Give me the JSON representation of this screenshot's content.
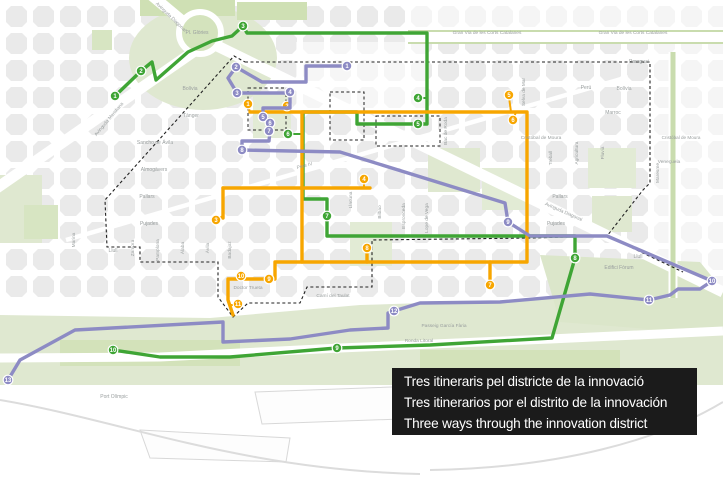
{
  "title_box": {
    "lines": [
      "Tres itineraris pel districte de la innovació",
      "Tres itinerarios por el distrito de la innovación",
      "Three ways through the innovation district"
    ],
    "bg_color": "#1b1b1b",
    "text_color": "#ffffff"
  },
  "map": {
    "colors": {
      "green_route": "#3fa535",
      "orange_route": "#f7a600",
      "purple_route": "#8d8bc4",
      "block": "#eaeaea",
      "park": "#dfe8d0",
      "park_bright": "#cfe0b4",
      "label": "#999e9e",
      "boundary": "#222222"
    },
    "place_labels": [
      {
        "t": "Gran Via de les Corts Catalanes",
        "x": 487,
        "y": 34,
        "s": 4.8
      },
      {
        "t": "Gran Via de les Corts Catalanes",
        "x": 633,
        "y": 34,
        "s": 4.8
      },
      {
        "t": "Pl. Glòries",
        "x": 197,
        "y": 34,
        "s": 5
      },
      {
        "t": "Avinguda Diagonal",
        "x": 170,
        "y": 18,
        "r": 44,
        "s": 4.8
      },
      {
        "t": "Avinguda Diagonal",
        "x": 563,
        "y": 213,
        "r": 24,
        "s": 4.8
      },
      {
        "t": "Avinguda Meridiana",
        "x": 110,
        "y": 120,
        "r": -50,
        "s": 4.8
      },
      {
        "t": "Pere IV",
        "x": 305,
        "y": 167,
        "r": -15,
        "s": 4.8
      },
      {
        "t": "Bolívia",
        "x": 190,
        "y": 90,
        "s": 5
      },
      {
        "t": "Bolívia",
        "x": 624,
        "y": 90,
        "s": 5
      },
      {
        "t": "Tànger",
        "x": 191,
        "y": 117,
        "s": 5
      },
      {
        "t": "Sancho de Ávila",
        "x": 155,
        "y": 144,
        "s": 5
      },
      {
        "t": "Almogàvers",
        "x": 154,
        "y": 171,
        "s": 5
      },
      {
        "t": "Pallars",
        "x": 147,
        "y": 198,
        "s": 5
      },
      {
        "t": "Pallars",
        "x": 560,
        "y": 198,
        "s": 5
      },
      {
        "t": "Pujades",
        "x": 149,
        "y": 225,
        "s": 5
      },
      {
        "t": "Pujades",
        "x": 556,
        "y": 225,
        "s": 5
      },
      {
        "t": "Llull",
        "x": 113,
        "y": 252,
        "s": 5
      },
      {
        "t": "Llull",
        "x": 638,
        "y": 258,
        "s": 5
      },
      {
        "t": "Doctor Trueta",
        "x": 248,
        "y": 289,
        "s": 4.8
      },
      {
        "t": "Camí del Taulat",
        "x": 333,
        "y": 297,
        "s": 4.8
      },
      {
        "t": "Passeig García Fària",
        "x": 444,
        "y": 327,
        "s": 4.8
      },
      {
        "t": "Ronda Litoral",
        "x": 419,
        "y": 342,
        "s": 4.8
      },
      {
        "t": "Cristóbal de Moura",
        "x": 541,
        "y": 139,
        "s": 4.8
      },
      {
        "t": "Cristóbal de Moura",
        "x": 681,
        "y": 139,
        "s": 4.6
      },
      {
        "t": "Marroc",
        "x": 613,
        "y": 114,
        "s": 5
      },
      {
        "t": "Perú",
        "x": 586,
        "y": 89,
        "s": 5
      },
      {
        "t": "Paraguai",
        "x": 639,
        "y": 63,
        "s": 5
      },
      {
        "t": "Veneçuela",
        "x": 669,
        "y": 163,
        "s": 4.8
      },
      {
        "t": "Edifici Fòrum",
        "x": 619,
        "y": 269,
        "s": 5
      },
      {
        "t": "Port Olímpic",
        "x": 114,
        "y": 398,
        "s": 5
      },
      {
        "t": "Marina",
        "x": 75,
        "y": 240,
        "r": -90,
        "s": 4.8
      },
      {
        "t": "Zamora",
        "x": 134,
        "y": 248,
        "r": -90,
        "s": 4.8
      },
      {
        "t": "Pamplona",
        "x": 159,
        "y": 250,
        "r": -90,
        "s": 4.8
      },
      {
        "t": "Àlaba",
        "x": 184,
        "y": 248,
        "r": -90,
        "s": 4.8
      },
      {
        "t": "Àvila",
        "x": 209,
        "y": 248,
        "r": -90,
        "s": 4.8
      },
      {
        "t": "Badajoz",
        "x": 231,
        "y": 250,
        "r": -90,
        "s": 4.8
      },
      {
        "t": "Llacuna",
        "x": 352,
        "y": 200,
        "r": -90,
        "s": 4.8
      },
      {
        "t": "Bilbao",
        "x": 381,
        "y": 212,
        "r": -90,
        "s": 4.8
      },
      {
        "t": "Espronceda",
        "x": 405,
        "y": 216,
        "r": -90,
        "s": 4.8
      },
      {
        "t": "Lope de Vega",
        "x": 428,
        "y": 218,
        "r": -90,
        "s": 4.8
      },
      {
        "t": "Bac de Roda",
        "x": 447,
        "y": 131,
        "r": -90,
        "s": 4.8
      },
      {
        "t": "Selva de Mar",
        "x": 525,
        "y": 92,
        "r": -90,
        "s": 4.8
      },
      {
        "t": "Treball",
        "x": 552,
        "y": 158,
        "r": -90,
        "s": 4.8
      },
      {
        "t": "Agricultura",
        "x": 578,
        "y": 153,
        "r": -90,
        "s": 4.8
      },
      {
        "t": "Fluvià",
        "x": 604,
        "y": 153,
        "r": -90,
        "s": 4.8
      },
      {
        "t": "Maresme",
        "x": 659,
        "y": 173,
        "r": -90,
        "s": 4.8
      }
    ],
    "boundary": {
      "loop": [
        [
          245,
          62
        ],
        [
          650,
          62
        ],
        [
          650,
          183
        ],
        [
          643,
          190
        ],
        [
          607,
          236
        ],
        [
          530,
          238
        ],
        [
          372,
          240
        ],
        [
          372,
          287
        ],
        [
          307,
          287
        ],
        [
          300,
          303
        ],
        [
          248,
          303
        ],
        [
          233,
          317
        ],
        [
          218,
          297
        ],
        [
          218,
          262
        ],
        [
          140,
          262
        ],
        [
          140,
          247
        ],
        [
          107,
          247
        ],
        [
          105,
          200
        ],
        [
          234,
          56
        ],
        [
          245,
          62
        ]
      ],
      "spur": [
        [
          607,
          236
        ],
        [
          683,
          272
        ]
      ],
      "inner_boxes": [
        [
          248,
          88,
          38,
          42
        ],
        [
          330,
          92,
          34,
          48
        ],
        [
          376,
          116,
          64,
          30
        ]
      ]
    },
    "routes": [
      {
        "id": "green-route",
        "color": "#3fa535",
        "paths": [
          [
            [
              115,
              96
            ],
            [
              141,
              71
            ],
            [
              152,
              62
            ],
            [
              156,
              80
            ],
            [
              188,
              52
            ],
            [
              212,
              41
            ],
            [
              232,
              36
            ],
            [
              243,
              26
            ],
            [
              247,
              33
            ],
            [
              427,
              33
            ],
            [
              427,
              124
            ],
            [
              357,
              124
            ],
            [
              357,
              112
            ],
            [
              303,
              112
            ],
            [
              303,
              199
            ],
            [
              327,
              199
            ],
            [
              327,
              236
            ],
            [
              575,
              236
            ],
            [
              575,
              258
            ],
            [
              552,
              338
            ],
            [
              430,
              345
            ],
            [
              337,
              348
            ],
            [
              230,
              357
            ],
            [
              160,
              357
            ],
            [
              113,
              350
            ]
          ]
        ],
        "stems": [
          [
            [
              418,
              98
            ],
            [
              427,
              98
            ]
          ],
          [
            [
              418,
              124
            ],
            [
              427,
              124
            ]
          ],
          [
            [
              288,
              134
            ],
            [
              303,
              134
            ]
          ]
        ],
        "markers": [
          {
            "n": "1",
            "x": 115,
            "y": 96
          },
          {
            "n": "2",
            "x": 141,
            "y": 71
          },
          {
            "n": "3",
            "x": 243,
            "y": 26
          },
          {
            "n": "4",
            "x": 418,
            "y": 98
          },
          {
            "n": "5",
            "x": 418,
            "y": 124
          },
          {
            "n": "6",
            "x": 288,
            "y": 134
          },
          {
            "n": "7",
            "x": 327,
            "y": 216
          },
          {
            "n": "8",
            "x": 575,
            "y": 258
          },
          {
            "n": "9",
            "x": 337,
            "y": 348
          },
          {
            "n": "10",
            "x": 113,
            "y": 350
          }
        ]
      },
      {
        "id": "orange-route",
        "color": "#f7a600",
        "paths": [
          [
            [
              250,
              112
            ],
            [
              527,
              112
            ],
            [
              527,
              262
            ],
            [
              275,
              262
            ],
            [
              275,
              279
            ],
            [
              228,
              279
            ],
            [
              228,
              300
            ],
            [
              233,
              315
            ]
          ],
          [
            [
              302,
              112
            ],
            [
              302,
              262
            ]
          ],
          [
            [
              223,
              188
            ],
            [
              370,
              188
            ]
          ],
          [
            [
              223,
              188
            ],
            [
              223,
              218
            ]
          ],
          [
            [
              490,
              262
            ],
            [
              490,
              279
            ]
          ],
          [
            [
              367,
              262
            ],
            [
              367,
              254
            ]
          ]
        ],
        "stems": [
          [
            [
              248,
              106
            ],
            [
              250,
              112
            ]
          ],
          [
            [
              287,
              107
            ],
            [
              287,
              112
            ]
          ],
          [
            [
              216,
              220
            ],
            [
              223,
              216
            ]
          ],
          [
            [
              364,
              181
            ],
            [
              364,
              188
            ]
          ],
          [
            [
              509,
              97
            ],
            [
              511,
              112
            ]
          ],
          [
            [
              513,
              120
            ],
            [
              516,
              112
            ]
          ],
          [
            [
              238,
              305
            ],
            [
              230,
              305
            ]
          ]
        ],
        "markers": [
          {
            "n": "1",
            "x": 248,
            "y": 104
          },
          {
            "n": "2",
            "x": 287,
            "y": 106
          },
          {
            "n": "3",
            "x": 216,
            "y": 220
          },
          {
            "n": "4",
            "x": 364,
            "y": 179
          },
          {
            "n": "5",
            "x": 509,
            "y": 95
          },
          {
            "n": "6",
            "x": 513,
            "y": 120
          },
          {
            "n": "7",
            "x": 490,
            "y": 285
          },
          {
            "n": "8",
            "x": 367,
            "y": 248
          },
          {
            "n": "9",
            "x": 269,
            "y": 279
          },
          {
            "n": "10",
            "x": 241,
            "y": 276
          },
          {
            "n": "11",
            "x": 238,
            "y": 304
          }
        ]
      },
      {
        "id": "purple-route",
        "color": "#8d8bc4",
        "paths": [
          [
            [
              347,
              66
            ],
            [
              306,
              66
            ],
            [
              306,
              82
            ],
            [
              262,
              82
            ],
            [
              236,
              67
            ],
            [
              228,
              78
            ],
            [
              237,
              93
            ],
            [
              290,
              93
            ],
            [
              290,
              108
            ],
            [
              263,
              108
            ],
            [
              263,
              117
            ],
            [
              270,
              120
            ],
            [
              270,
              131
            ],
            [
              269,
              141
            ],
            [
              242,
              141
            ],
            [
              242,
              150
            ],
            [
              340,
              152
            ],
            [
              505,
              203
            ],
            [
              508,
              222
            ],
            [
              530,
              236
            ],
            [
              607,
              236
            ],
            [
              712,
              281
            ],
            [
              700,
              289
            ],
            [
              678,
              289
            ],
            [
              670,
              295
            ],
            [
              649,
              300
            ],
            [
              590,
              294
            ],
            [
              500,
              302
            ],
            [
              420,
              303
            ],
            [
              394,
              311
            ],
            [
              388,
              313
            ],
            [
              388,
              328
            ],
            [
              350,
              330
            ],
            [
              290,
              339
            ],
            [
              223,
              342
            ],
            [
              223,
              322
            ],
            [
              75,
              330
            ],
            [
              20,
              360
            ],
            [
              8,
              380
            ]
          ]
        ],
        "stems": [],
        "markers": [
          {
            "n": "1",
            "x": 347,
            "y": 66
          },
          {
            "n": "2",
            "x": 236,
            "y": 67
          },
          {
            "n": "3",
            "x": 237,
            "y": 93
          },
          {
            "n": "4",
            "x": 290,
            "y": 92
          },
          {
            "n": "5",
            "x": 263,
            "y": 117
          },
          {
            "n": "6",
            "x": 270,
            "y": 123
          },
          {
            "n": "7",
            "x": 269,
            "y": 131
          },
          {
            "n": "8",
            "x": 242,
            "y": 150
          },
          {
            "n": "9",
            "x": 508,
            "y": 222
          },
          {
            "n": "10",
            "x": 712,
            "y": 281
          },
          {
            "n": "11",
            "x": 649,
            "y": 300
          },
          {
            "n": "12",
            "x": 394,
            "y": 311
          },
          {
            "n": "13",
            "x": 8,
            "y": 380
          }
        ]
      }
    ]
  }
}
